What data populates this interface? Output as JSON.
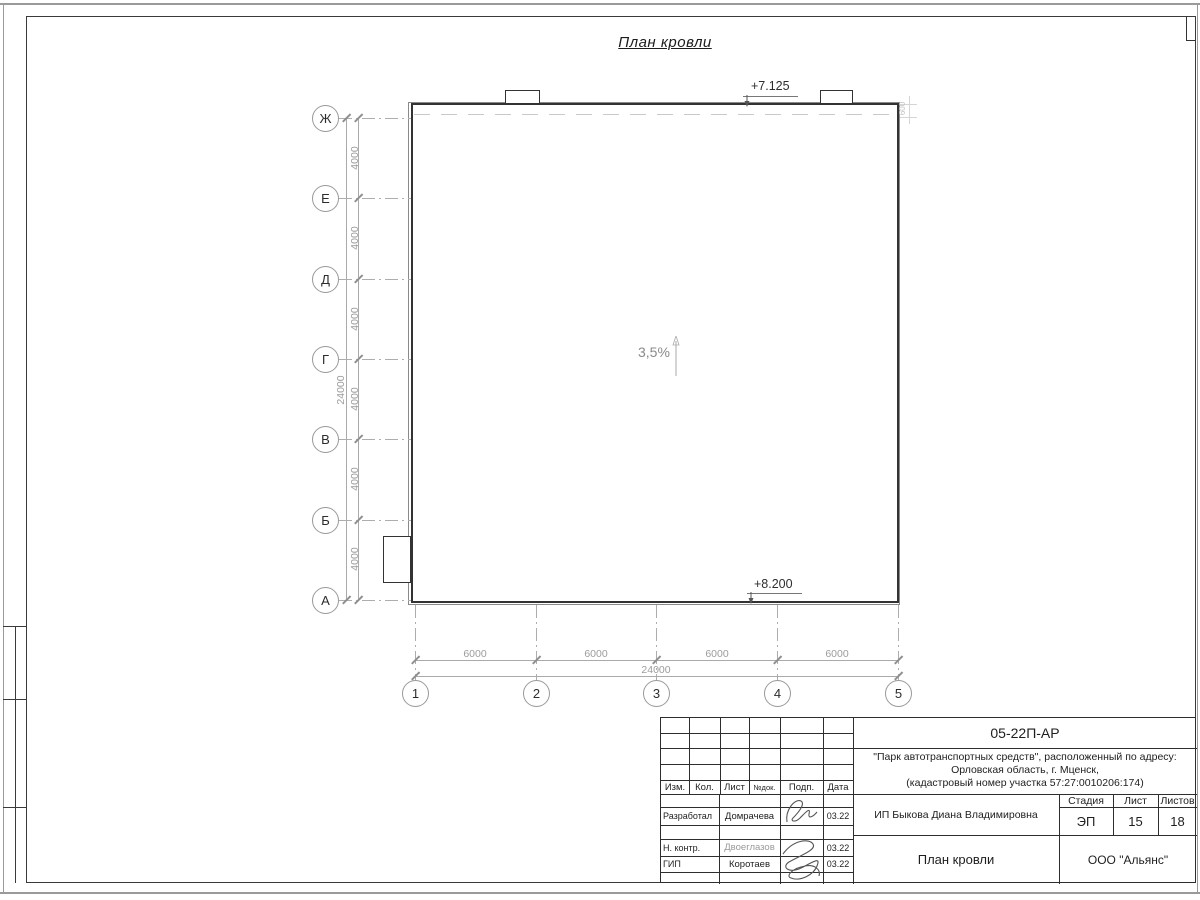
{
  "drawing": {
    "title": "План кровли",
    "slope_label": "3,5%",
    "elevation_top": "+7.125",
    "elevation_bottom": "+8.200",
    "parapet_dim": "600",
    "axes": {
      "left": [
        "Ж",
        "Е",
        "Д",
        "Г",
        "В",
        "Б",
        "А"
      ],
      "bottom": [
        "1",
        "2",
        "3",
        "4",
        "5"
      ]
    },
    "dimensions": {
      "left_segments": [
        "4000",
        "4000",
        "4000",
        "4000",
        "4000",
        "4000"
      ],
      "left_total": "24000",
      "bottom_segments": [
        "6000",
        "6000",
        "6000",
        "6000"
      ],
      "bottom_total": "24000"
    }
  },
  "titleblock": {
    "code": "05-22П-АР",
    "project": {
      "line1": "\"Парк автотранспортных средств\",  расположенный по адресу:",
      "line2": "Орловская область, г. Мценск,",
      "line3": "(кадастровый номер участка 57:27:0010206:174)"
    },
    "header": {
      "izm": "Изм.",
      "kol": "Кол.",
      "list": "Лист",
      "ndok": "№док.",
      "podp": "Подп.",
      "data": "Дата"
    },
    "rows": [
      {
        "role": "Разработал",
        "name": "Домрачева",
        "date": "03.22"
      },
      {
        "role": "Н. контр.",
        "name": "Двоеглазов",
        "date": "03.22"
      },
      {
        "role": "ГИП",
        "name": "Коротаев",
        "date": "03.22"
      }
    ],
    "customer": "ИП Быкова Диана Владимировна",
    "sheet_title": "План кровли",
    "stage_label": "Стадия",
    "stage_value": "ЭП",
    "sheet_label": "Лист",
    "sheet_value": "15",
    "sheets_label": "Листов",
    "sheets_value": "18",
    "company": "ООО \"Альянс\""
  }
}
